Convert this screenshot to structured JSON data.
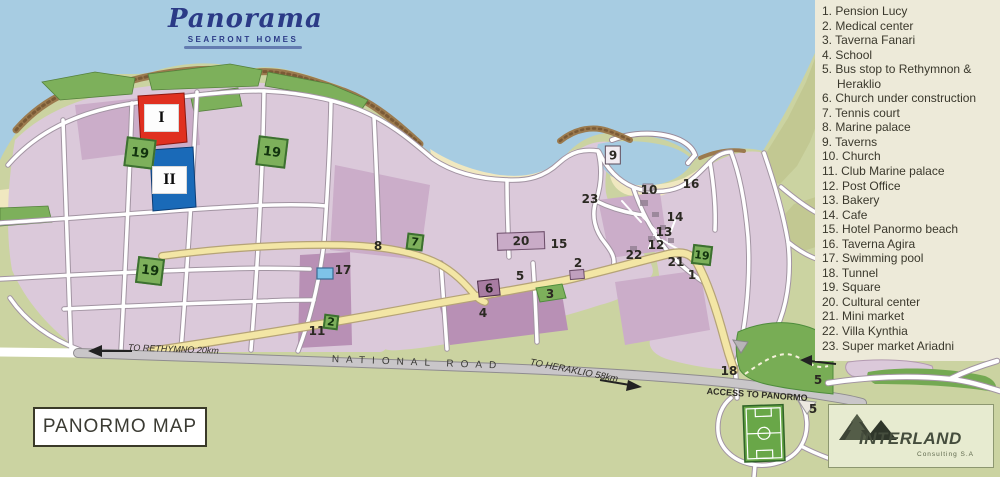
{
  "logo": {
    "name": "Panorama",
    "tagline": "SEAFRONT HOMES"
  },
  "legend": {
    "items": [
      {
        "num": "1.",
        "label": "Pension Lucy"
      },
      {
        "num": "2.",
        "label": "Medical center"
      },
      {
        "num": "3.",
        "label": "Taverna Fanari"
      },
      {
        "num": "4.",
        "label": "School"
      },
      {
        "num": "5.",
        "label": "Bus stop to Rethymnon & Heraklio"
      },
      {
        "num": "6.",
        "label": "Church under construction"
      },
      {
        "num": "7.",
        "label": "Tennis court"
      },
      {
        "num": "8.",
        "label": "Marine palace"
      },
      {
        "num": "9.",
        "label": "Taverns"
      },
      {
        "num": "10.",
        "label": "Church"
      },
      {
        "num": "11.",
        "label": "Club Marine palace"
      },
      {
        "num": "12.",
        "label": "Post Office"
      },
      {
        "num": "13.",
        "label": "Bakery"
      },
      {
        "num": "14.",
        "label": "Cafe"
      },
      {
        "num": "15.",
        "label": "Hotel Panormo beach"
      },
      {
        "num": "16.",
        "label": "Taverna Agira"
      },
      {
        "num": "17.",
        "label": "Swimming pool"
      },
      {
        "num": "18.",
        "label": "Tunnel"
      },
      {
        "num": "19.",
        "label": "Square"
      },
      {
        "num": "20.",
        "label": "Cultural center"
      },
      {
        "num": "21.",
        "label": "Mini market"
      },
      {
        "num": "22.",
        "label": "Villa Kynthia"
      },
      {
        "num": "23.",
        "label": "Super market Ariadni"
      }
    ]
  },
  "roads": {
    "national": "NATIONAL ROAD",
    "to_rethymno": "TO RETHYMNO 20km",
    "to_heraklio": "TO HERAKLIO 58km",
    "access": "ACCESS TO PANORMO"
  },
  "map": {
    "title": "PANORMO MAP",
    "phase_blocks": [
      {
        "label": "I"
      },
      {
        "label": "II"
      }
    ],
    "markers": [
      {
        "label": "8",
        "x": 378,
        "y": 246
      },
      {
        "label": "15",
        "x": 559,
        "y": 244
      },
      {
        "label": "23",
        "x": 590,
        "y": 199
      },
      {
        "label": "10",
        "x": 649,
        "y": 190
      },
      {
        "label": "16",
        "x": 691,
        "y": 184
      },
      {
        "label": "14",
        "x": 675,
        "y": 217
      },
      {
        "label": "13",
        "x": 664,
        "y": 232
      },
      {
        "label": "12",
        "x": 656,
        "y": 245
      },
      {
        "label": "22",
        "x": 634,
        "y": 255
      },
      {
        "label": "21",
        "x": 676,
        "y": 262
      },
      {
        "label": "1",
        "x": 692,
        "y": 275
      },
      {
        "label": "2",
        "x": 578,
        "y": 263
      },
      {
        "label": "5",
        "x": 520,
        "y": 276
      },
      {
        "label": "3",
        "x": 550,
        "y": 294
      },
      {
        "label": "4",
        "x": 483,
        "y": 313
      },
      {
        "label": "11",
        "x": 317,
        "y": 331
      },
      {
        "label": "17",
        "x": 343,
        "y": 270
      },
      {
        "label": "18",
        "x": 729,
        "y": 371
      },
      {
        "label": "5",
        "x": 818,
        "y": 380
      },
      {
        "label": "5",
        "x": 813,
        "y": 409
      },
      {
        "label": "9",
        "kind": "whitebox",
        "x": 613,
        "y": 155
      },
      {
        "label": "6",
        "kind": "darkbox",
        "x": 489,
        "y": 288
      },
      {
        "label": "20",
        "kind": "widebox",
        "x": 521,
        "y": 241
      },
      {
        "label": "19",
        "kind": "green",
        "size": 30,
        "x": 140,
        "y": 153
      },
      {
        "label": "19",
        "kind": "green",
        "size": 30,
        "x": 272,
        "y": 152
      },
      {
        "label": "19",
        "kind": "green",
        "size": 27,
        "x": 150,
        "y": 271
      },
      {
        "label": "19",
        "kind": "green",
        "size": 20,
        "x": 702,
        "y": 255
      },
      {
        "label": "7",
        "kind": "green",
        "size": 17,
        "x": 415,
        "y": 242
      },
      {
        "label": "2",
        "kind": "green",
        "size": 15,
        "x": 331,
        "y": 322
      }
    ]
  },
  "branding": {
    "company": "INTERLAND",
    "subtitle": "Consulting S.A"
  },
  "colors": {
    "sea": "#a7cce2",
    "land": "#cbd3a1",
    "legend_bg": "#edead9",
    "town_pink": "#dbc9da",
    "town_pink_dark": "#b890b5",
    "phase1_red": "#e03020",
    "phase2_blue": "#1a6ab8",
    "square_green": "#7db05b",
    "yellow_road": "#f3e6a5",
    "national_gray": "#c9c6c9"
  }
}
